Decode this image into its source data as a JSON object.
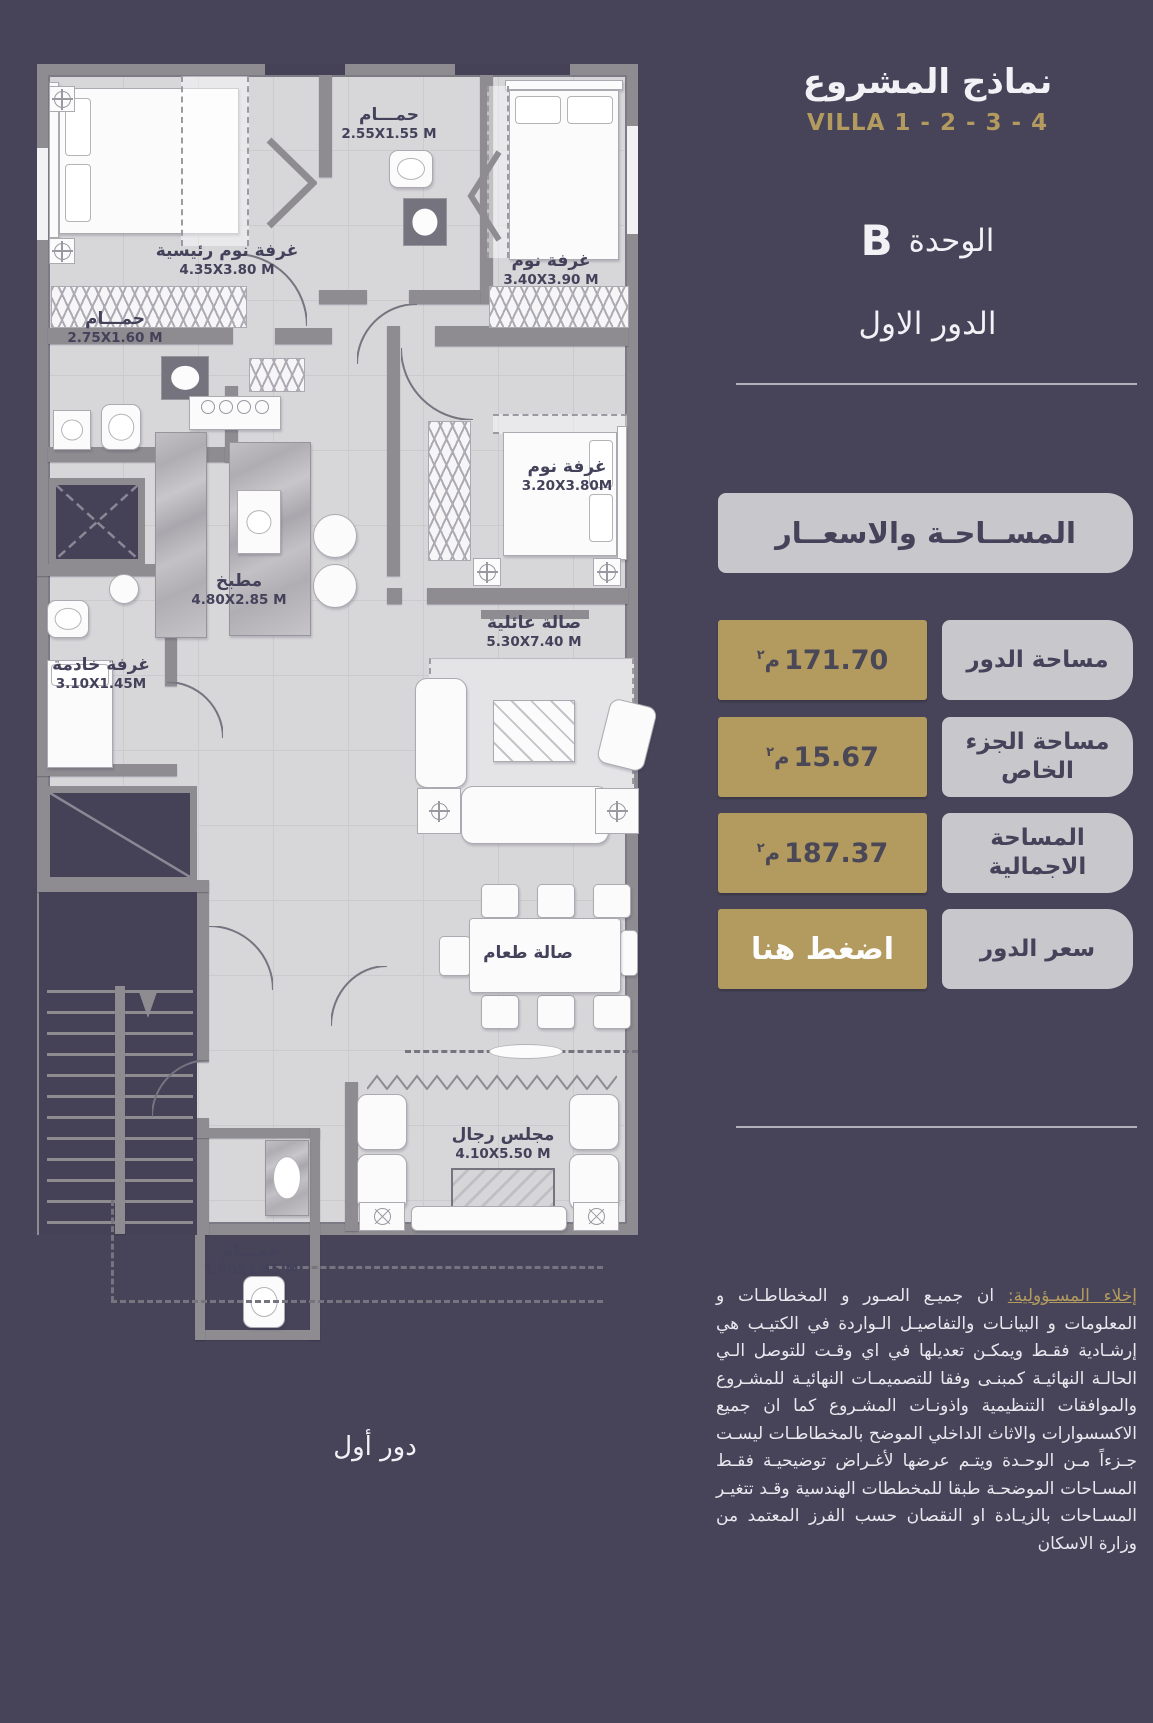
{
  "page": {
    "colors": {
      "background": "#474459",
      "gold": "#B39B5F",
      "panel_gray": "#C8C7CC",
      "navy_text": "#45425A"
    }
  },
  "header": {
    "title": "نماذج المشروع",
    "villa": "VILLA 1 - 2 - 3 - 4",
    "unit_label": "الوحدة",
    "unit_value": "B",
    "floor_label": "الدور الاول"
  },
  "pricing": {
    "section_title": "المســاحـة والاسعــار",
    "rows": [
      {
        "label": "مساحة الدور",
        "value": "171.70",
        "unit": "م",
        "unit_sup": "٢"
      },
      {
        "label": "مساحة الجزء الخاص",
        "value": "15.67",
        "unit": "م",
        "unit_sup": "٢"
      },
      {
        "label": "المساحة الاجمالية",
        "value": "187.37",
        "unit": "م",
        "unit_sup": "٢"
      },
      {
        "label": "سعر الدور",
        "value": "اضغط هنا",
        "unit": "",
        "unit_sup": ""
      }
    ]
  },
  "disclaimer": {
    "lead": "إخلاء المسـؤولية:",
    "body": "ان جميـع الصـور و المخطاطـات و المعلومات و البيانـات والتفاصيـل الـواردة في الكتيـب هي إرشـادية فقـط ويمكـن تعديلها في اي وقـت للتوصل الـي الحالـة النهائيـة كمبنـى وفقا للتصميمـات النهائيـة للمشـروع والموافقات التنظيمية واذونـات المشـروع كما ان جميع الاكسسوارات والاثاث الداخلي الموضح بالمخطاطـات ليسـت جـزءاً مـن الوحـدة ويتـم عرضها لأغـراض توضيحيـة فقـط المسـاحات الموضحـة طبقا للمخططات الهندسية وقـد تتغيـر المسـاحات بالزيـادة او النقصان حسب الفرز المعتمد من وزارة الاسكان"
  },
  "plan": {
    "caption": "دور أول",
    "rooms": [
      {
        "name": "غرفة نوم رئيسية",
        "dim": "4.35X3.80 M"
      },
      {
        "name": "حمـــام",
        "dim": "2.55X1.55 M"
      },
      {
        "name": "غرفة نوم",
        "dim": "3.40X3.90 M"
      },
      {
        "name": "حمـــام",
        "dim": "2.75X1.60 M"
      },
      {
        "name": "غرفة نوم",
        "dim": "3.20X3.80M"
      },
      {
        "name": "مطبخ",
        "dim": "4.80X2.85 M"
      },
      {
        "name": "صالة عائلية",
        "dim": "5.30X7.40 M"
      },
      {
        "name": "غرفة خادمة",
        "dim": "3.10X1.45M"
      },
      {
        "name": "صالة طعام",
        "dim": ""
      },
      {
        "name": "مجلس رجال",
        "dim": "4.10X5.50 M"
      },
      {
        "name": "حمـــام",
        "dim": "1.60X1.45 M"
      }
    ]
  }
}
